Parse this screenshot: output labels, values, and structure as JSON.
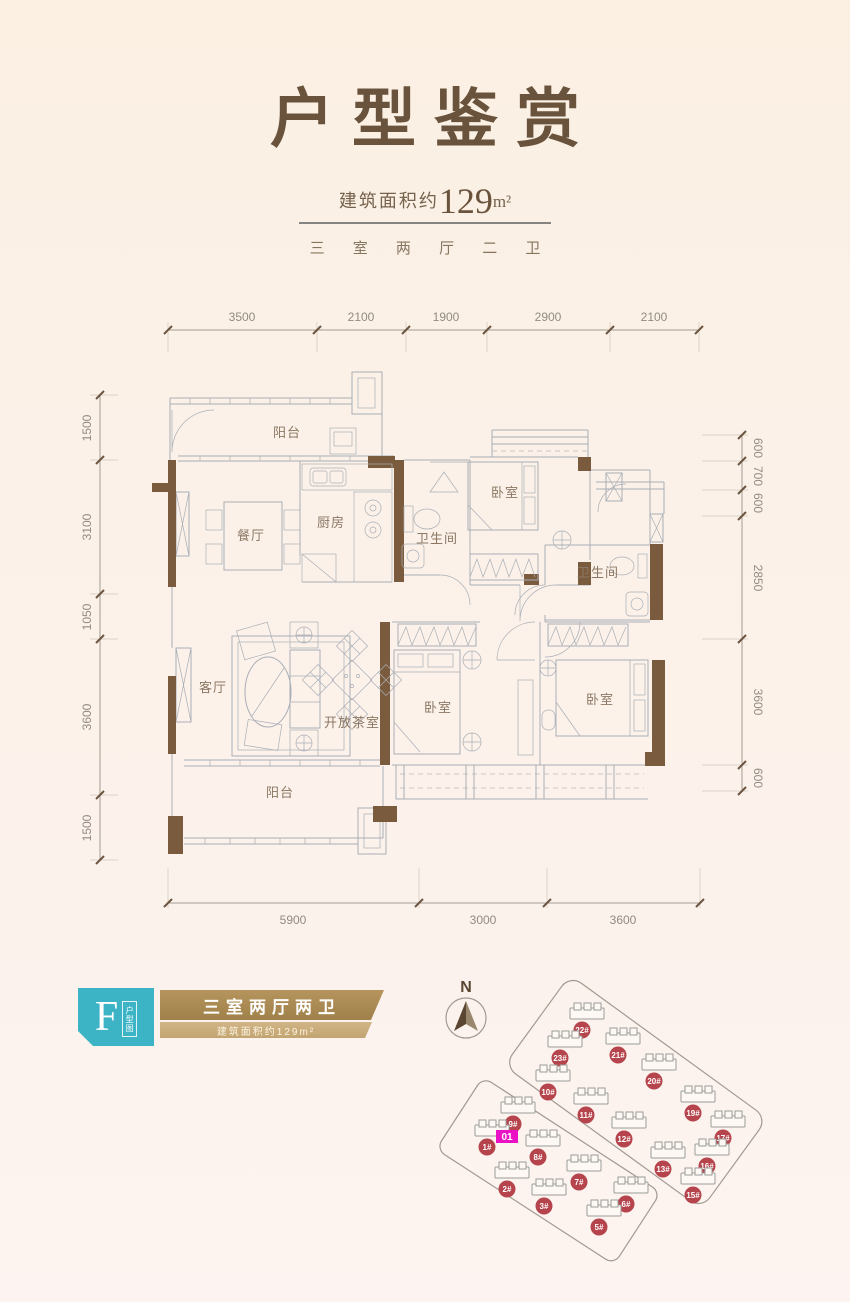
{
  "header": {
    "title": "户型鉴赏",
    "area_prefix": "建筑面积约",
    "area_value": "129",
    "area_unit": "m²",
    "subtitle": "三 室 两 厅 二 卫"
  },
  "floorplan": {
    "rooms": {
      "balcony_top": "阳台",
      "dining": "餐厅",
      "kitchen": "厨房",
      "bath1": "卫生间",
      "bedroom_top": "卧室",
      "bath2": "卫生间",
      "living": "客厅",
      "tea_room": "开放茶室",
      "bedroom_mid": "卧室",
      "bedroom_right": "卧室",
      "balcony_bottom": "阳台"
    },
    "dims": {
      "top": [
        "3500",
        "2100",
        "1900",
        "2900",
        "2100"
      ],
      "left": [
        "1500",
        "3100",
        "1050",
        "3600",
        "1500"
      ],
      "right": [
        "600",
        "700",
        "600",
        "2850",
        "3600",
        "600"
      ],
      "bottom": [
        "5900",
        "3000",
        "3600"
      ]
    }
  },
  "type_card": {
    "letter": "F",
    "tag": "户型图",
    "name": "三室两厅两卫",
    "area": "建筑面积约129m²"
  },
  "siteplan": {
    "north_label": "N",
    "unit_label": "01",
    "unit_x": 507,
    "unit_y": 1136,
    "buildings": [
      {
        "id": "22#",
        "x": 582,
        "y": 1030
      },
      {
        "id": "23#",
        "x": 560,
        "y": 1058
      },
      {
        "id": "21#",
        "x": 618,
        "y": 1055
      },
      {
        "id": "20#",
        "x": 654,
        "y": 1081
      },
      {
        "id": "10#",
        "x": 548,
        "y": 1092
      },
      {
        "id": "19#",
        "x": 693,
        "y": 1113
      },
      {
        "id": "11#",
        "x": 586,
        "y": 1115
      },
      {
        "id": "9#",
        "x": 513,
        "y": 1124
      },
      {
        "id": "12#",
        "x": 624,
        "y": 1139
      },
      {
        "id": "17#",
        "x": 723,
        "y": 1138
      },
      {
        "id": "1#",
        "x": 487,
        "y": 1147
      },
      {
        "id": "8#",
        "x": 538,
        "y": 1157
      },
      {
        "id": "13#",
        "x": 663,
        "y": 1169
      },
      {
        "id": "16#",
        "x": 707,
        "y": 1166
      },
      {
        "id": "7#",
        "x": 579,
        "y": 1182
      },
      {
        "id": "2#",
        "x": 507,
        "y": 1189
      },
      {
        "id": "15#",
        "x": 693,
        "y": 1195
      },
      {
        "id": "3#",
        "x": 544,
        "y": 1206
      },
      {
        "id": "6#",
        "x": 626,
        "y": 1204
      },
      {
        "id": "5#",
        "x": 599,
        "y": 1227
      }
    ]
  },
  "colors": {
    "title_brown": "#6a533c",
    "wall_brown": "#7b5b3d",
    "plan_line": "#a9aeb6",
    "teal_badge": "#3cb4c6",
    "gold_banner": "#a1814a",
    "building_badge_red": "#b5444c",
    "unit_magenta": "#ea12c4"
  }
}
